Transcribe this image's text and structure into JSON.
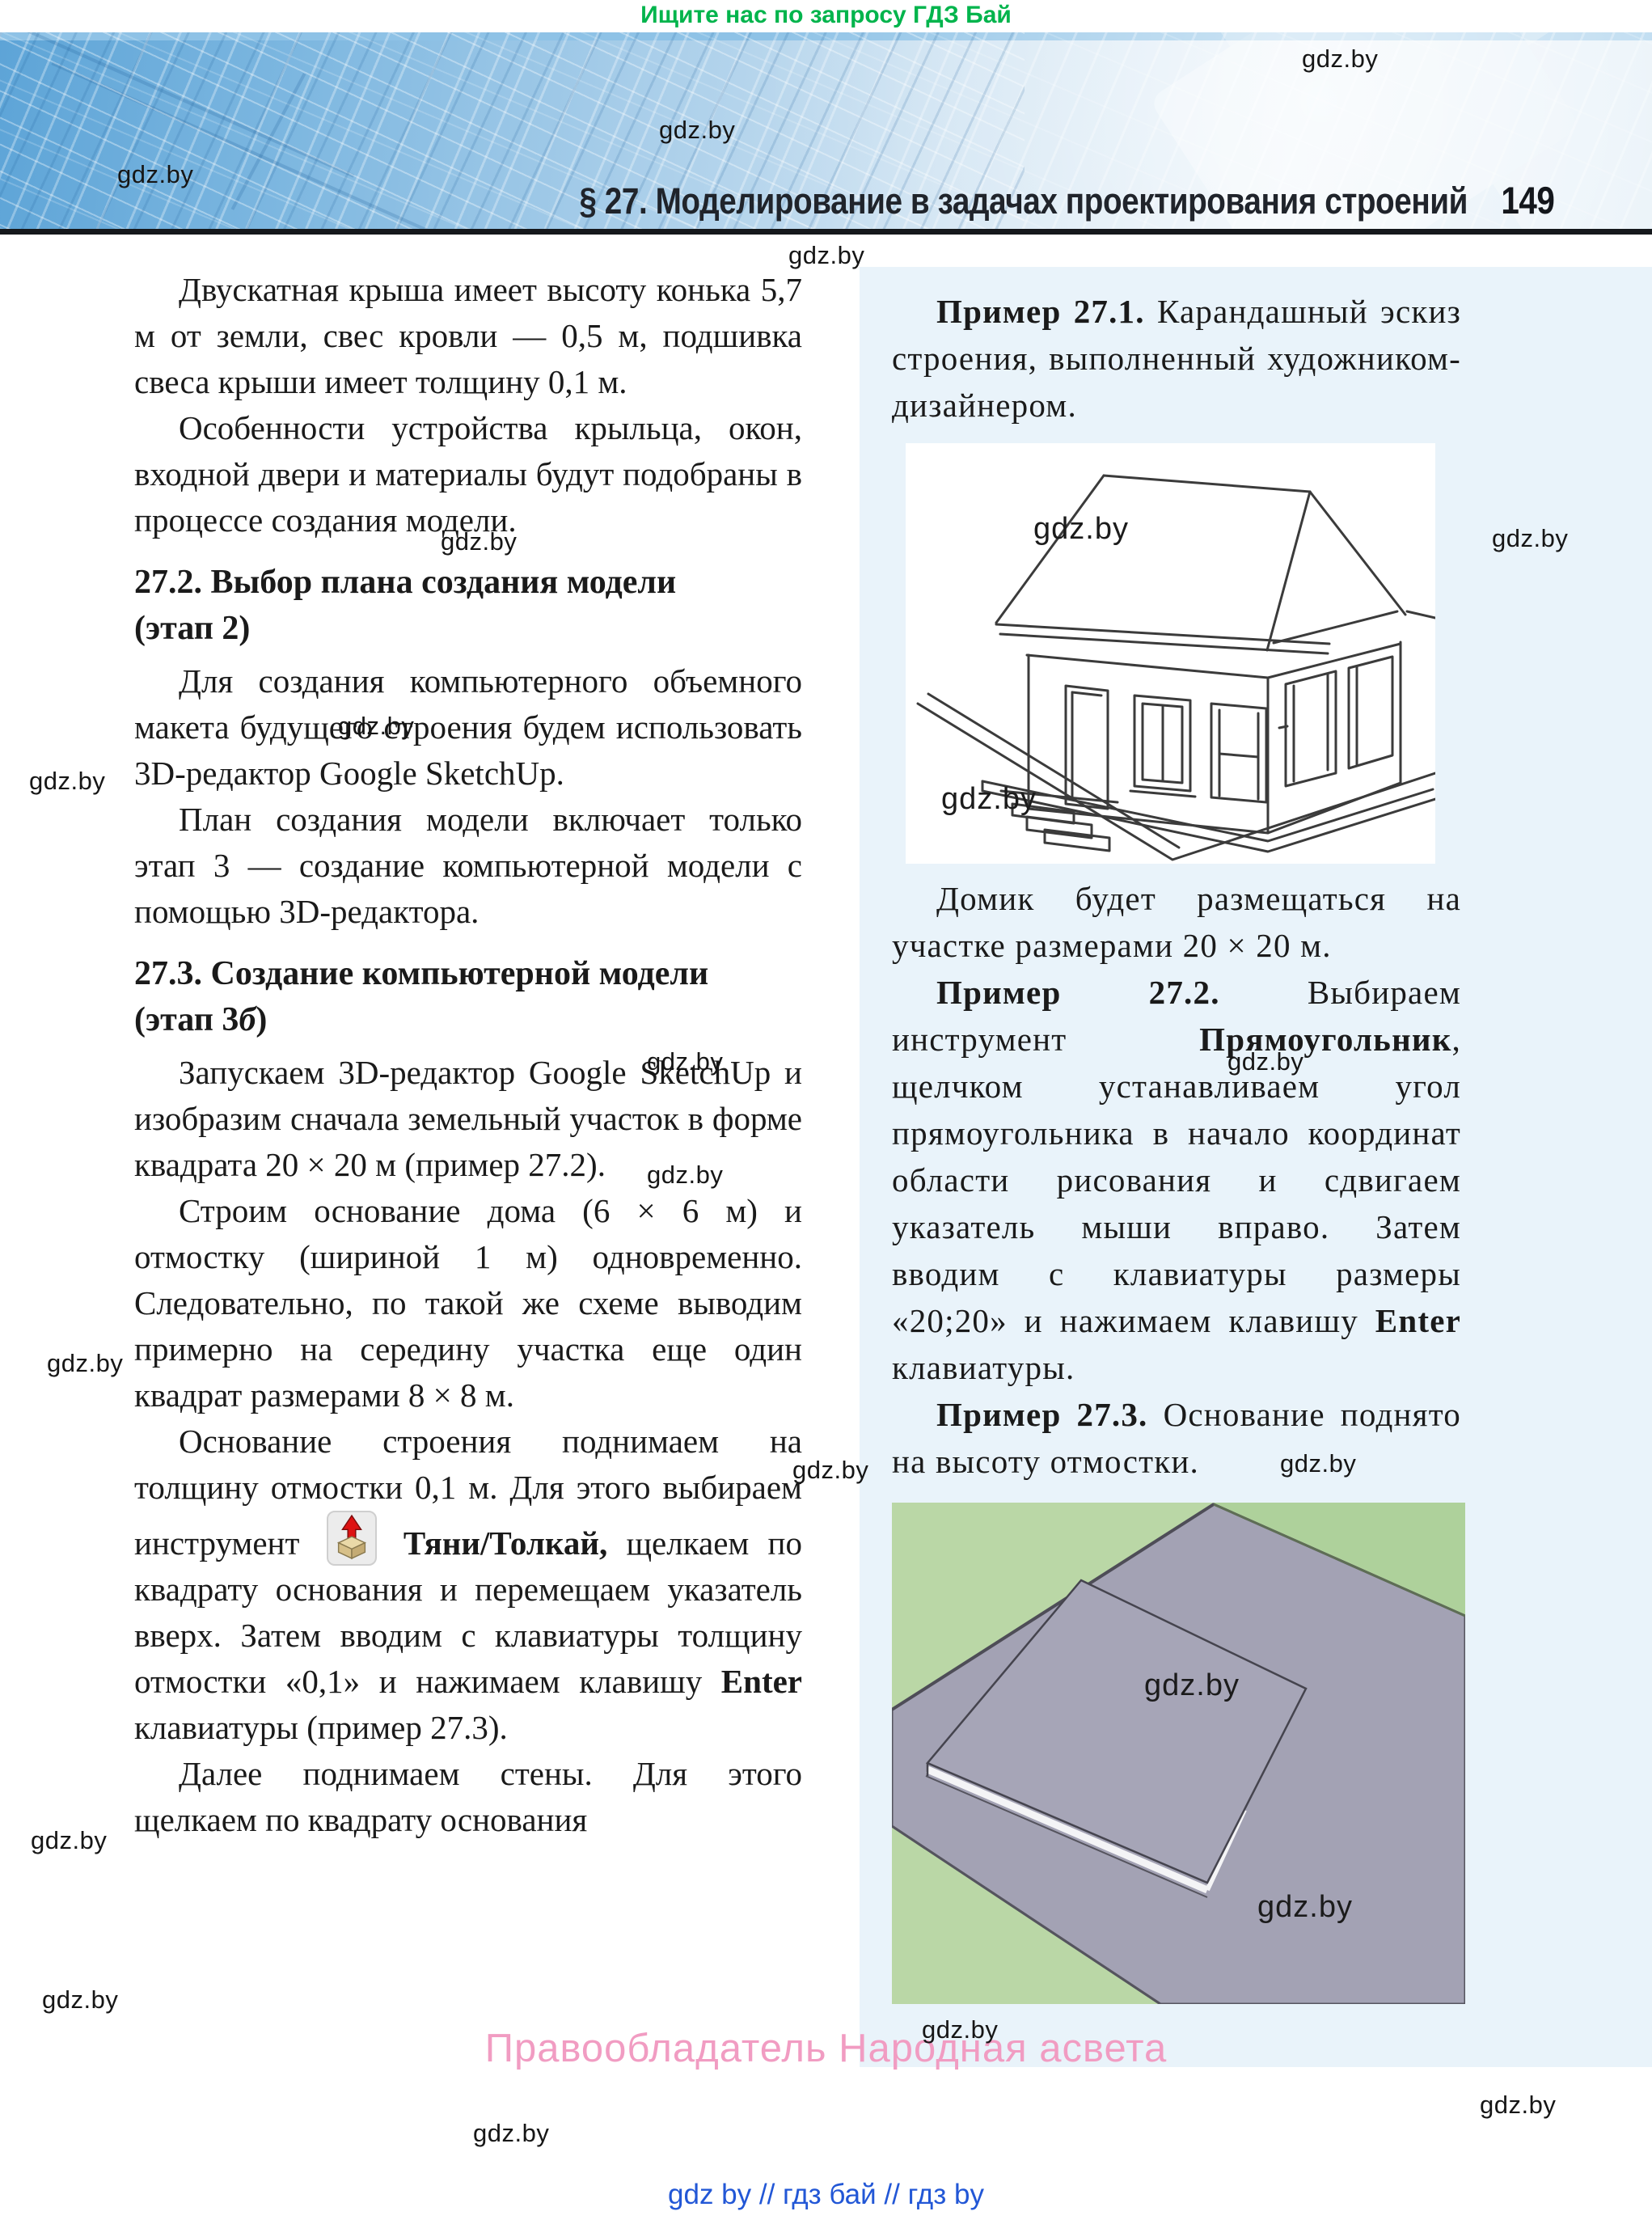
{
  "promo": {
    "text": "Ищите нас по запросу ГДЗ Бай",
    "color": "#00b44c"
  },
  "watermark": {
    "text": "gdz.by"
  },
  "header": {
    "section_title": "§ 27. Моделирование в задачах проектирования строений",
    "page_number": "149"
  },
  "left": {
    "p1": "Двускатная крыша имеет высоту конька 5,7 м от земли, свес кровли — 0,5 м, подшивка свеса крыши имеет толщину 0,1 м.",
    "p2": "Особенности устройства крыльца, окон, входной двери и материалы будут подобраны в процессе создания модели.",
    "h272_l1": "27.2. Выбор плана создания модели",
    "h272_l2": "(этап 2)",
    "p3": "Для создания компьютерного объемного макета будущего строения будем использовать 3D-редактор Google SketchUp.",
    "p4": "План создания модели включает только этап 3 — создание компьютерной модели с помощью 3D-редактора.",
    "h273_l1": "27.3. Создание компьютерной модели",
    "h273_l2a": "(этап 3",
    "h273_l2b": "б",
    "h273_l2c": ")",
    "p5": "Запускаем 3D-редактор Google SketchUp и изобразим сначала земельный участок в форме квадрата 20 × 20 м (пример 27.2).",
    "p6": "Строим основание дома (6 × 6 м) и отмостку (шириной 1 м) одновременно. Следовательно, по такой же схеме выводим примерно на середину участка еще один квадрат размерами 8 × 8 м.",
    "p7a": "Основание строения поднимаем на толщину отмостки 0,1 м. Для этого выбираем инструмент",
    "p7b": "Тяни/Толкай,",
    "p7c": " щелкаем по квадрату основания и перемещаем указатель вверх. Затем вводим с клавиатуры толщину отмостки «0,1» и нажимаем клавишу ",
    "p7d": "Enter",
    "p7e": " клавиатуры (пример 27.3).",
    "p8": "Далее поднимаем стены. Для этого щелкаем по квадрату основания"
  },
  "panel": {
    "example1_label": "Пример 27.1.",
    "example1_text": " Карандашный эскиз строения, выполненный художником-дизайнером.",
    "caption_after_sketch": "Домик будет размещаться на участке размерами 20 × 20 м.",
    "example2_label": "Пример 27.2.",
    "example2_t1": " Выбираем инструмент ",
    "example2_tool": "Прямоугольник",
    "example2_t2": ", щелчком устанавливаем угол прямоугольника в начало координат области рисования и сдвигаем указатель мыши вправо. Затем вводим с клавиатуры размеры «20;20» и нажимаем клавишу ",
    "example2_enter": "Enter",
    "example2_t3": " клавиатуры.",
    "example3_label": "Пример 27.3.",
    "example3_text": " Основание поднято на высоту отмостки.",
    "panel_bg": "#e9f3fa"
  },
  "figures": {
    "house_sketch_alt": "Карандашный эскиз одноэтажного дома с двускатной крышей",
    "terrain_alt": "3D-вид земельного участка с поднятым основанием (Google SketchUp)",
    "terrain_colors": {
      "ground_green": "#bad7a6",
      "plot_gray": "#a3a2b4"
    }
  },
  "footer": {
    "copyright": "Правообладатель Народная асвета",
    "copyright_color": "#f19cc2",
    "links": "gdz by  //  гдз бай  //  гдз by",
    "links_color": "#2257d6"
  }
}
